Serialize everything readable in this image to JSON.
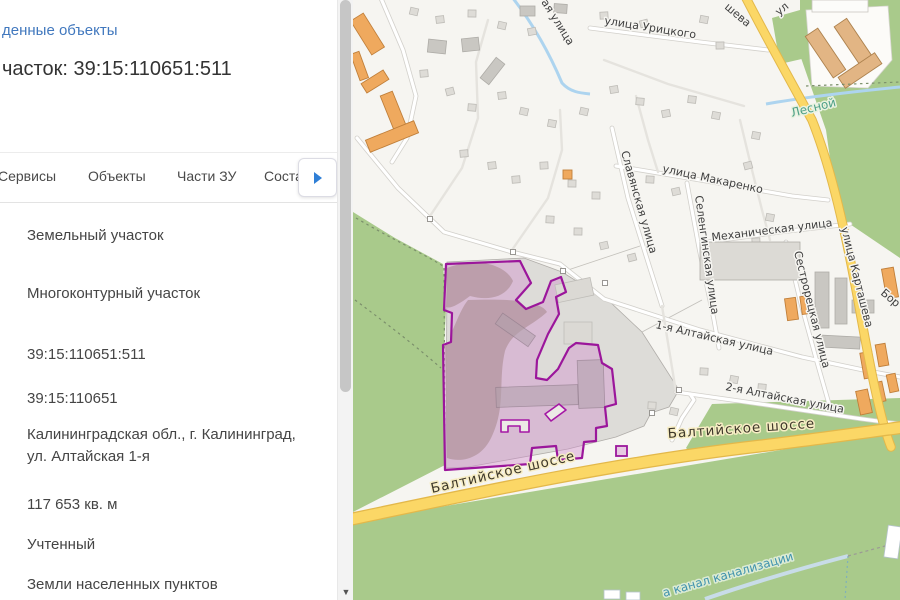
{
  "panel": {
    "back_link": "денные объекты",
    "title": "часток: 39:15:110651:511",
    "tabs": [
      "Сервисы",
      "Объекты",
      "Части ЗУ",
      "Составные ЗУ"
    ],
    "attributes": [
      "Земельный участок",
      "Многоконтурный участок",
      "39:15:110651:511",
      "39:15:110651",
      "Калининградская обл., г. Калининград, ул. Алтайская 1-я",
      "117 653 кв. м",
      "Учтенный",
      "Земли населенных пунктов"
    ]
  },
  "map": {
    "parcel_number": "39:15:110651:511",
    "labels": [
      {
        "t": "улица Урицкого",
        "x": 604,
        "y": 24,
        "r": 9,
        "c": "st"
      },
      {
        "t": "шева",
        "x": 724,
        "y": 8,
        "r": 40,
        "c": "st"
      },
      {
        "t": "ая улица",
        "x": 541,
        "y": 2,
        "r": 58,
        "c": "st"
      },
      {
        "t": "ул",
        "x": 779,
        "y": 16,
        "r": -40,
        "c": "st"
      },
      {
        "t": "улица Макаренко",
        "x": 662,
        "y": 172,
        "r": 12,
        "c": "st"
      },
      {
        "t": "Славянская улица",
        "x": 621,
        "y": 152,
        "r": 74,
        "c": "st"
      },
      {
        "t": "Селенгинская улица",
        "x": 695,
        "y": 196,
        "r": 82,
        "c": "st"
      },
      {
        "t": "Механическая улица",
        "x": 712,
        "y": 241,
        "r": -7,
        "c": "st"
      },
      {
        "t": "Сестрорецкая улица",
        "x": 794,
        "y": 252,
        "r": 76,
        "c": "st"
      },
      {
        "t": "улица Карташева",
        "x": 841,
        "y": 228,
        "r": 76,
        "c": "st"
      },
      {
        "t": "Бор",
        "x": 880,
        "y": 294,
        "r": 40,
        "c": "st"
      },
      {
        "t": "1-я Алтайская улица",
        "x": 655,
        "y": 328,
        "r": 13,
        "c": "st"
      },
      {
        "t": "2-я Алтайская улица",
        "x": 725,
        "y": 390,
        "r": 11,
        "c": "st"
      },
      {
        "t": "Балтийское шоссе",
        "x": 432,
        "y": 493,
        "r": -13,
        "c": "hw"
      },
      {
        "t": "Балтийское шоссе",
        "x": 668,
        "y": 438,
        "r": -4,
        "c": "hw"
      },
      {
        "t": "Лесной",
        "x": 792,
        "y": 117,
        "r": -14,
        "c": "wt1"
      },
      {
        "t": "а канал канализации",
        "x": 664,
        "y": 597,
        "r": -16,
        "c": "wt2"
      }
    ]
  },
  "colors": {
    "link_blue": "#4178be",
    "accent_blue": "#2f7fd6",
    "parcel_outline": "#9b169b",
    "parcel_fill": "#e5c6e3",
    "road_major": "#fbd766",
    "green_area": "#a9ca8b"
  }
}
